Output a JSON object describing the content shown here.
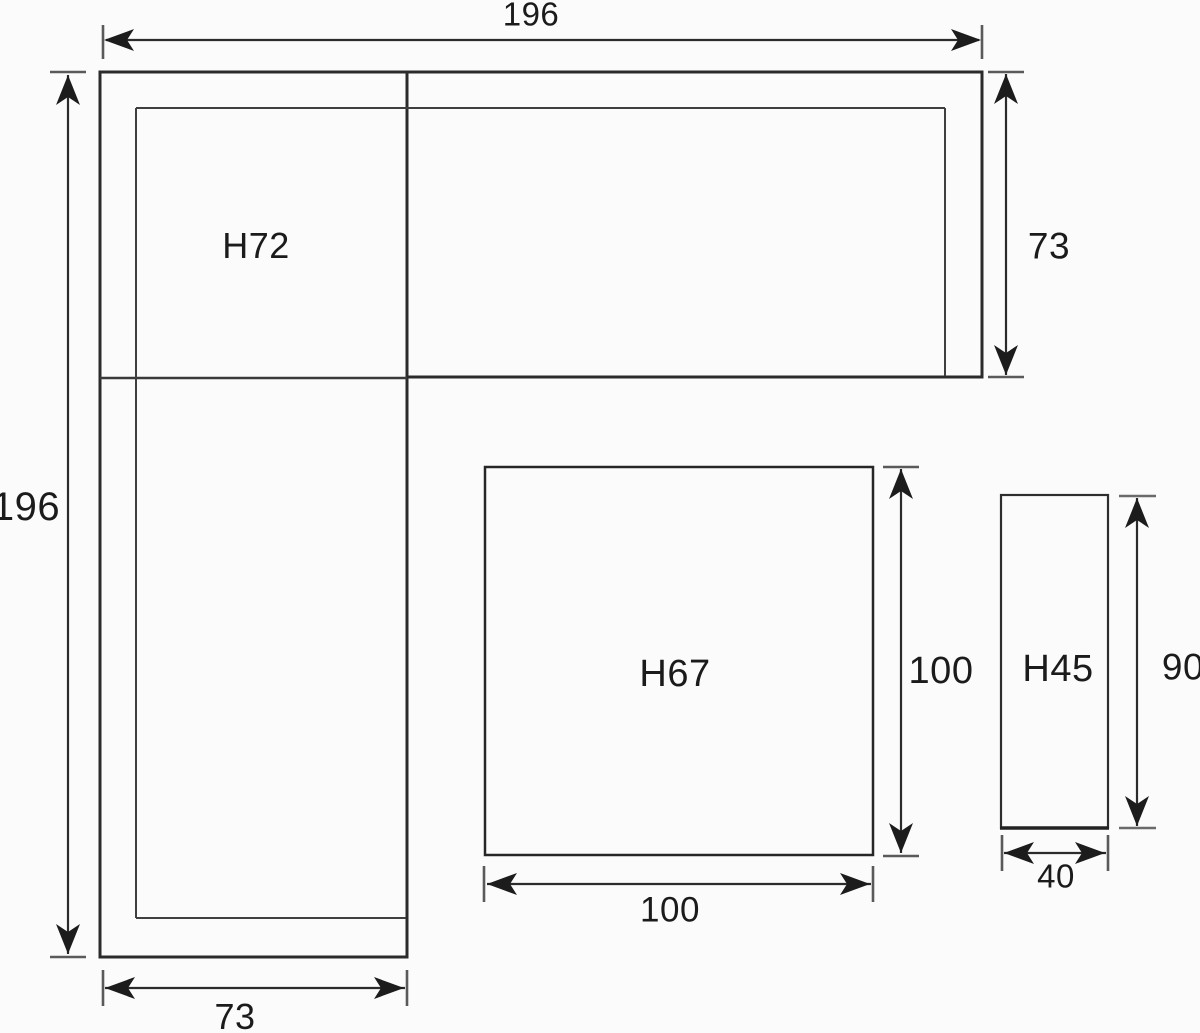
{
  "page": {
    "background": "#fbfbfb",
    "line_color": "#2b2b2b",
    "tick_color": "#5a5a5a",
    "text_color": "#1b1b1b"
  },
  "labels": {
    "dim_total_width": "196",
    "dim_total_depth": "196",
    "dim_right_arm_depth": "73",
    "dim_left_arm_width": "73",
    "piece_corner_sofa": "H72",
    "piece_coffee_table": "H67",
    "dim_table_depth": "100",
    "dim_table_width": "100",
    "piece_side_table": "H45",
    "dim_side_depth": "90",
    "dim_side_width": "40"
  }
}
